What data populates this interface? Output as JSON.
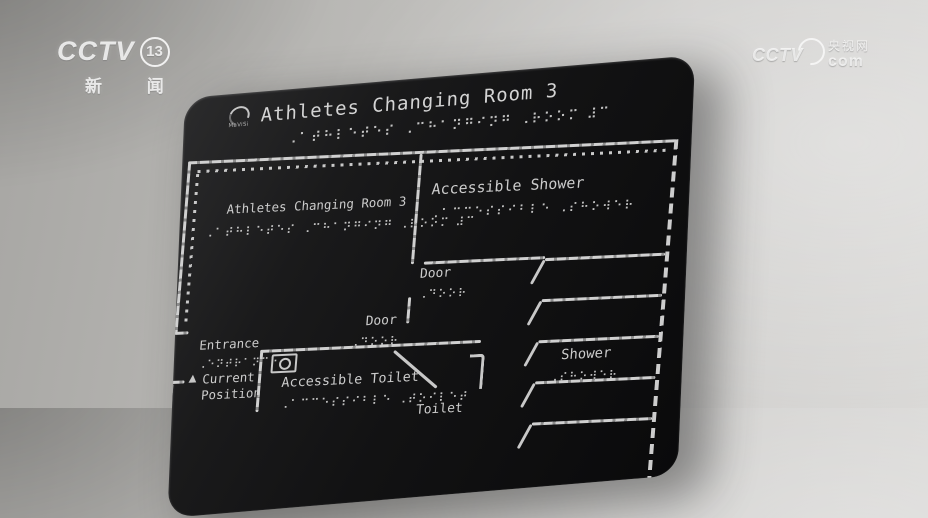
{
  "watermarks": {
    "cctv13": {
      "brand": "CCTV",
      "channel_number": "13",
      "subtitle": "新 闻"
    },
    "cctv_com": {
      "brand": "CCTV",
      "site_name": "央视网",
      "site_domain": "com"
    }
  },
  "plaque": {
    "maker_logo": "MaViSi",
    "title": "Athletes Changing Room 3",
    "title_braille": "⠠⠁⠞⠓⠇⠑⠞⠑⠎ ⠠⠉⠓⠁⠝⠛⠊⠝⠛ ⠠⠗⠕⠕⠍ ⠼⠉",
    "map": {
      "changing_room": {
        "label": "Athletes Changing Room 3",
        "braille": "⠠⠁⠞⠓⠇⠑⠞⠑⠎ ⠠⠉⠓⠁⠝⠛⠊⠝⠛ ⠠⠗⠕⠕⠍ ⠼⠉"
      },
      "accessible_shower": {
        "label": "Accessible Shower",
        "braille": "⠠⠁⠉⠉⠑⠎⠎⠊⠃⠇⠑ ⠠⠎⠓⠕⠺⠑⠗"
      },
      "door_upper": {
        "label": "Door",
        "braille": "⠠⠙⠕⠕⠗"
      },
      "door_lower": {
        "label": "Door",
        "braille": "⠠⠙⠕⠕⠗"
      },
      "shower": {
        "label": "Shower",
        "braille": "⠠⠎⠓⠕⠺⠑⠗"
      },
      "entrance": {
        "label": "Entrance",
        "braille": "⠠⠑⠝⠞⠗⠁⠝⠉⠑"
      },
      "current_position": {
        "marker": "▲",
        "label": "Current Position"
      },
      "accessible_toilet": {
        "label": "Accessible Toilet",
        "braille": "⠠⠁⠉⠉⠑⠎⠎⠊⠃⠇⠑ ⠠⠞⠕⠊⠇⠑⠞"
      },
      "toilet": {
        "label": "Toilet"
      }
    }
  },
  "colors": {
    "plaque": "#131313",
    "engraving": "#c9c9c9",
    "wall_light": "#d8d7d5",
    "wall_dark": "#a7a6a3",
    "watermark": "#ffffff"
  }
}
